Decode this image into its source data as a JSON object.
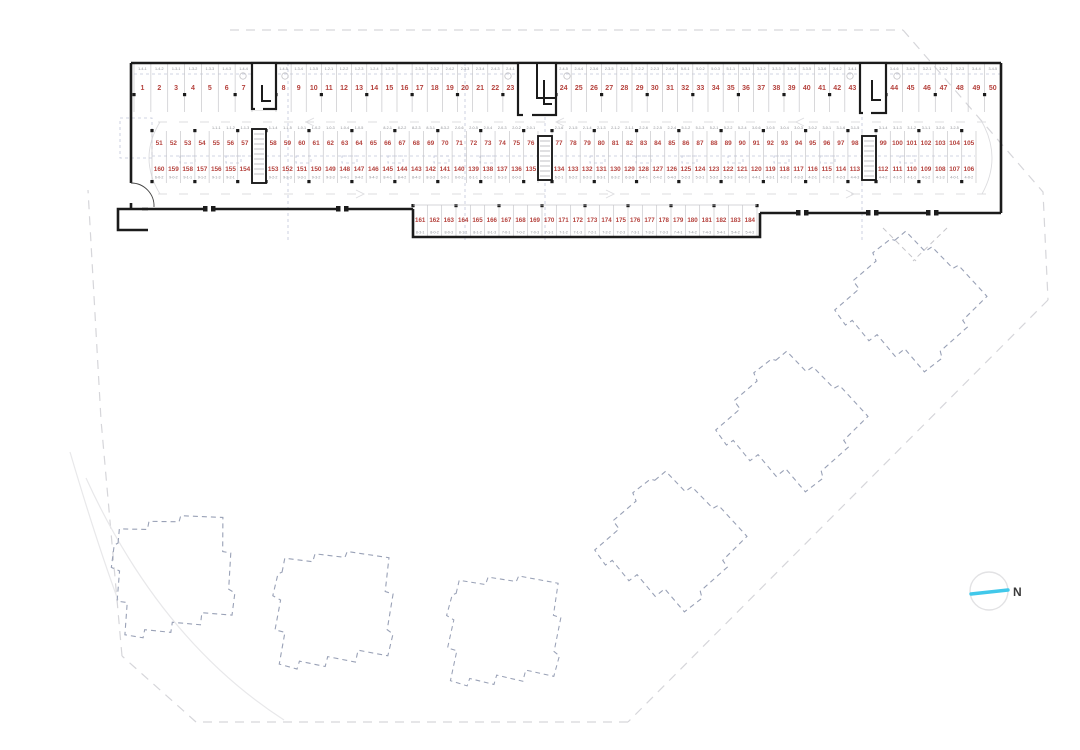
{
  "north": {
    "label": "N"
  },
  "colors": {
    "wall": "#1b1b1b",
    "divider": "#c7c7cb",
    "space_number": "#b5423d",
    "unit_label": "#8e9096",
    "grid_dash": "#b7bdd4",
    "building_dash": "#99a1b6",
    "boundary_dash": "#d6d6da",
    "lane_dash": "#dcdcdf",
    "north_line": "#41c8ea",
    "north_text": "#3a3a3a"
  },
  "rows": [
    {
      "id": "top-row",
      "segments": [
        {
          "numbers": [
            "1",
            "2",
            "3",
            "4",
            "5",
            "6",
            "7"
          ],
          "labels": [
            "1-4-1",
            "1-4-2",
            "1-3-1",
            "1-3-2",
            "1-3-3",
            "1-4-3",
            "1-4-4"
          ]
        },
        {
          "numbers": [
            "8",
            "9",
            "10",
            "11",
            "12",
            "13",
            "14",
            "15",
            "16",
            "17",
            "18",
            "19",
            "20",
            "21",
            "22",
            "23"
          ],
          "labels": [
            "1-4-5",
            "1-3-4",
            "1-3-5",
            "1-2-1",
            "1-2-2",
            "1-2-3",
            "1-2-4",
            "1-2-5",
            "",
            "2-3-1",
            "2-3-2",
            "2-4-2",
            "2-3-3",
            "2-3-4",
            "2-4-3",
            "2-4-1"
          ]
        },
        {
          "numbers": [
            "24",
            "25",
            "26",
            "27",
            "28",
            "29",
            "30",
            "31",
            "32",
            "33",
            "34",
            "35",
            "36",
            "37",
            "38",
            "39",
            "40",
            "41",
            "42",
            "43"
          ],
          "labels": [
            "2-4-5",
            "2-4-4",
            "2-3-6",
            "2-3-5",
            "2-2-1",
            "2-2-2",
            "2-2-3",
            "2-4-6",
            "5-0-1",
            "5-0-2",
            "5-0-3",
            "5-1-1",
            "3-3-1",
            "3-3-2",
            "3-3-3",
            "3-3-4",
            "3-3-5",
            "3-3-6",
            "3-4-2",
            "3-4-1"
          ]
        },
        {
          "numbers": [
            "44",
            "45",
            "46",
            "47",
            "48",
            "49",
            "50"
          ],
          "labels": [
            "3-4-6",
            "3-4-3",
            "3-2-1",
            "3-2-2",
            "3-2-3",
            "3-4-4",
            "3-4-5"
          ]
        }
      ]
    },
    {
      "id": "mid-upper-row",
      "segments": [
        {
          "numbers": [
            "51",
            "52",
            "53",
            "54",
            "55",
            "56",
            "57"
          ],
          "labels": [
            "",
            "",
            "",
            "",
            "1-1-1",
            "1-1-2",
            "1-1-3"
          ]
        },
        {
          "numbers": [
            "58",
            "59",
            "60",
            "61",
            "62",
            "63",
            "64",
            "65",
            "66",
            "67",
            "68",
            "69",
            "70",
            "71",
            "72",
            "73",
            "74",
            "75",
            "76"
          ],
          "labels": [
            "1-1-4",
            "1-1-5",
            "1-0-1",
            "1-0-2",
            "1-0-3",
            "1-0-4",
            "1-0-5",
            "",
            "8-2-1",
            "8-2-2",
            "8-2-3",
            "8-3-1",
            "8-3-2",
            "2-0-6",
            "2-0-5",
            "2-0-4",
            "2-0-3",
            "2-0-2",
            "2-0-1"
          ]
        },
        {
          "numbers": [
            "77",
            "78",
            "79",
            "80",
            "81",
            "82",
            "83",
            "84",
            "85",
            "86",
            "87",
            "88",
            "89",
            "90",
            "91",
            "92",
            "93",
            "94",
            "95",
            "96",
            "97",
            "98"
          ],
          "labels": [
            "2-1-6",
            "2-1-5",
            "2-1-4",
            "2-1-3",
            "2-1-2",
            "2-1-1",
            "2-2-6",
            "2-2-5",
            "2-2-4",
            "5-1-2",
            "5-1-3",
            "5-2-1",
            "5-2-2",
            "5-2-4",
            "3-0-6",
            "3-0-5",
            "3-0-4",
            "3-0-3",
            "3-0-2",
            "3-0-1",
            "3-1-6",
            "3-1-5"
          ]
        },
        {
          "numbers": [
            "99",
            "100",
            "101",
            "102",
            "103",
            "104",
            "105"
          ],
          "labels": [
            "3-1-4",
            "3-1-3",
            "3-1-2",
            "3-1-1",
            "3-2-6",
            "3-2-5",
            ""
          ]
        }
      ]
    },
    {
      "id": "mid-lower-row",
      "segments": [
        {
          "numbers": [
            "160",
            "159",
            "158",
            "157",
            "156",
            "155",
            "154"
          ],
          "labels": [
            "6-0-2",
            "9-0-2",
            "9-1-1",
            "9-1-2",
            "9-1-3",
            "9-2-1",
            ""
          ]
        },
        {
          "numbers": [
            "153",
            "152",
            "151",
            "150",
            "149",
            "148",
            "147",
            "146",
            "145",
            "144",
            "143",
            "142",
            "141",
            "140",
            "139",
            "138",
            "137",
            "136",
            "135"
          ],
          "labels": [
            "9-2-2",
            "9-2-3",
            "9-3-1",
            "9-3-2",
            "9-3-3",
            "9-4-1",
            "9-4-2",
            "9-4-3",
            "8-4-1",
            "8-4-2",
            "8-4-3",
            "8-3-3",
            "6-0-1",
            "6-0-2",
            "6-1-1",
            "6-1-2",
            "6-1-3",
            "6-0-3",
            ""
          ]
        },
        {
          "numbers": [
            "134",
            "133",
            "132",
            "131",
            "130",
            "129",
            "128",
            "127",
            "126",
            "125",
            "124",
            "123",
            "122",
            "121",
            "120",
            "119",
            "118",
            "117",
            "116",
            "115",
            "114",
            "113"
          ],
          "labels": [
            "6-2-1",
            "6-2-2",
            "6-2-3",
            "6-3-1",
            "6-3-2",
            "6-3-3",
            "6-4-1",
            "6-4-2",
            "6-4-3",
            "5-2-3",
            "5-3-1",
            "5-3-2",
            "5-3-3",
            "4-0-3",
            "4-4-1",
            "4-3-1",
            "4-3-2",
            "4-3-3",
            "4-2-1",
            "4-2-2",
            "4-2-3",
            "4-4-3"
          ]
        },
        {
          "numbers": [
            "112",
            "111",
            "110",
            "109",
            "108",
            "107",
            "106"
          ],
          "labels": [
            "4-4-2",
            "4-1-5",
            "4-1-1",
            "4-1-2",
            "4-1-3",
            "4-0-1",
            "4-0-2"
          ]
        }
      ]
    },
    {
      "id": "bottom-row",
      "segments": [
        {
          "numbers": [
            "161",
            "162",
            "163",
            "164",
            "165",
            "166",
            "167",
            "168",
            "169",
            "170",
            "171",
            "172",
            "173",
            "174",
            "175",
            "176",
            "177",
            "178",
            "179",
            "180",
            "181",
            "182",
            "183",
            "184"
          ],
          "labels": [
            "8-3-1",
            "8-0-2",
            "8-0-3",
            "8-1-1",
            "8-1-2",
            "8-1-3",
            "7-0-1",
            "7-0-2",
            "7-0-3",
            "7-1-1",
            "7-1-2",
            "7-1-3",
            "7-2-1",
            "7-2-2",
            "7-2-3",
            "7-3-1",
            "7-3-2",
            "7-3-3",
            "7-4-1",
            "7-4-2",
            "7-4-3",
            "5-4-1",
            "5-4-2",
            "5-4-3"
          ]
        }
      ]
    }
  ]
}
